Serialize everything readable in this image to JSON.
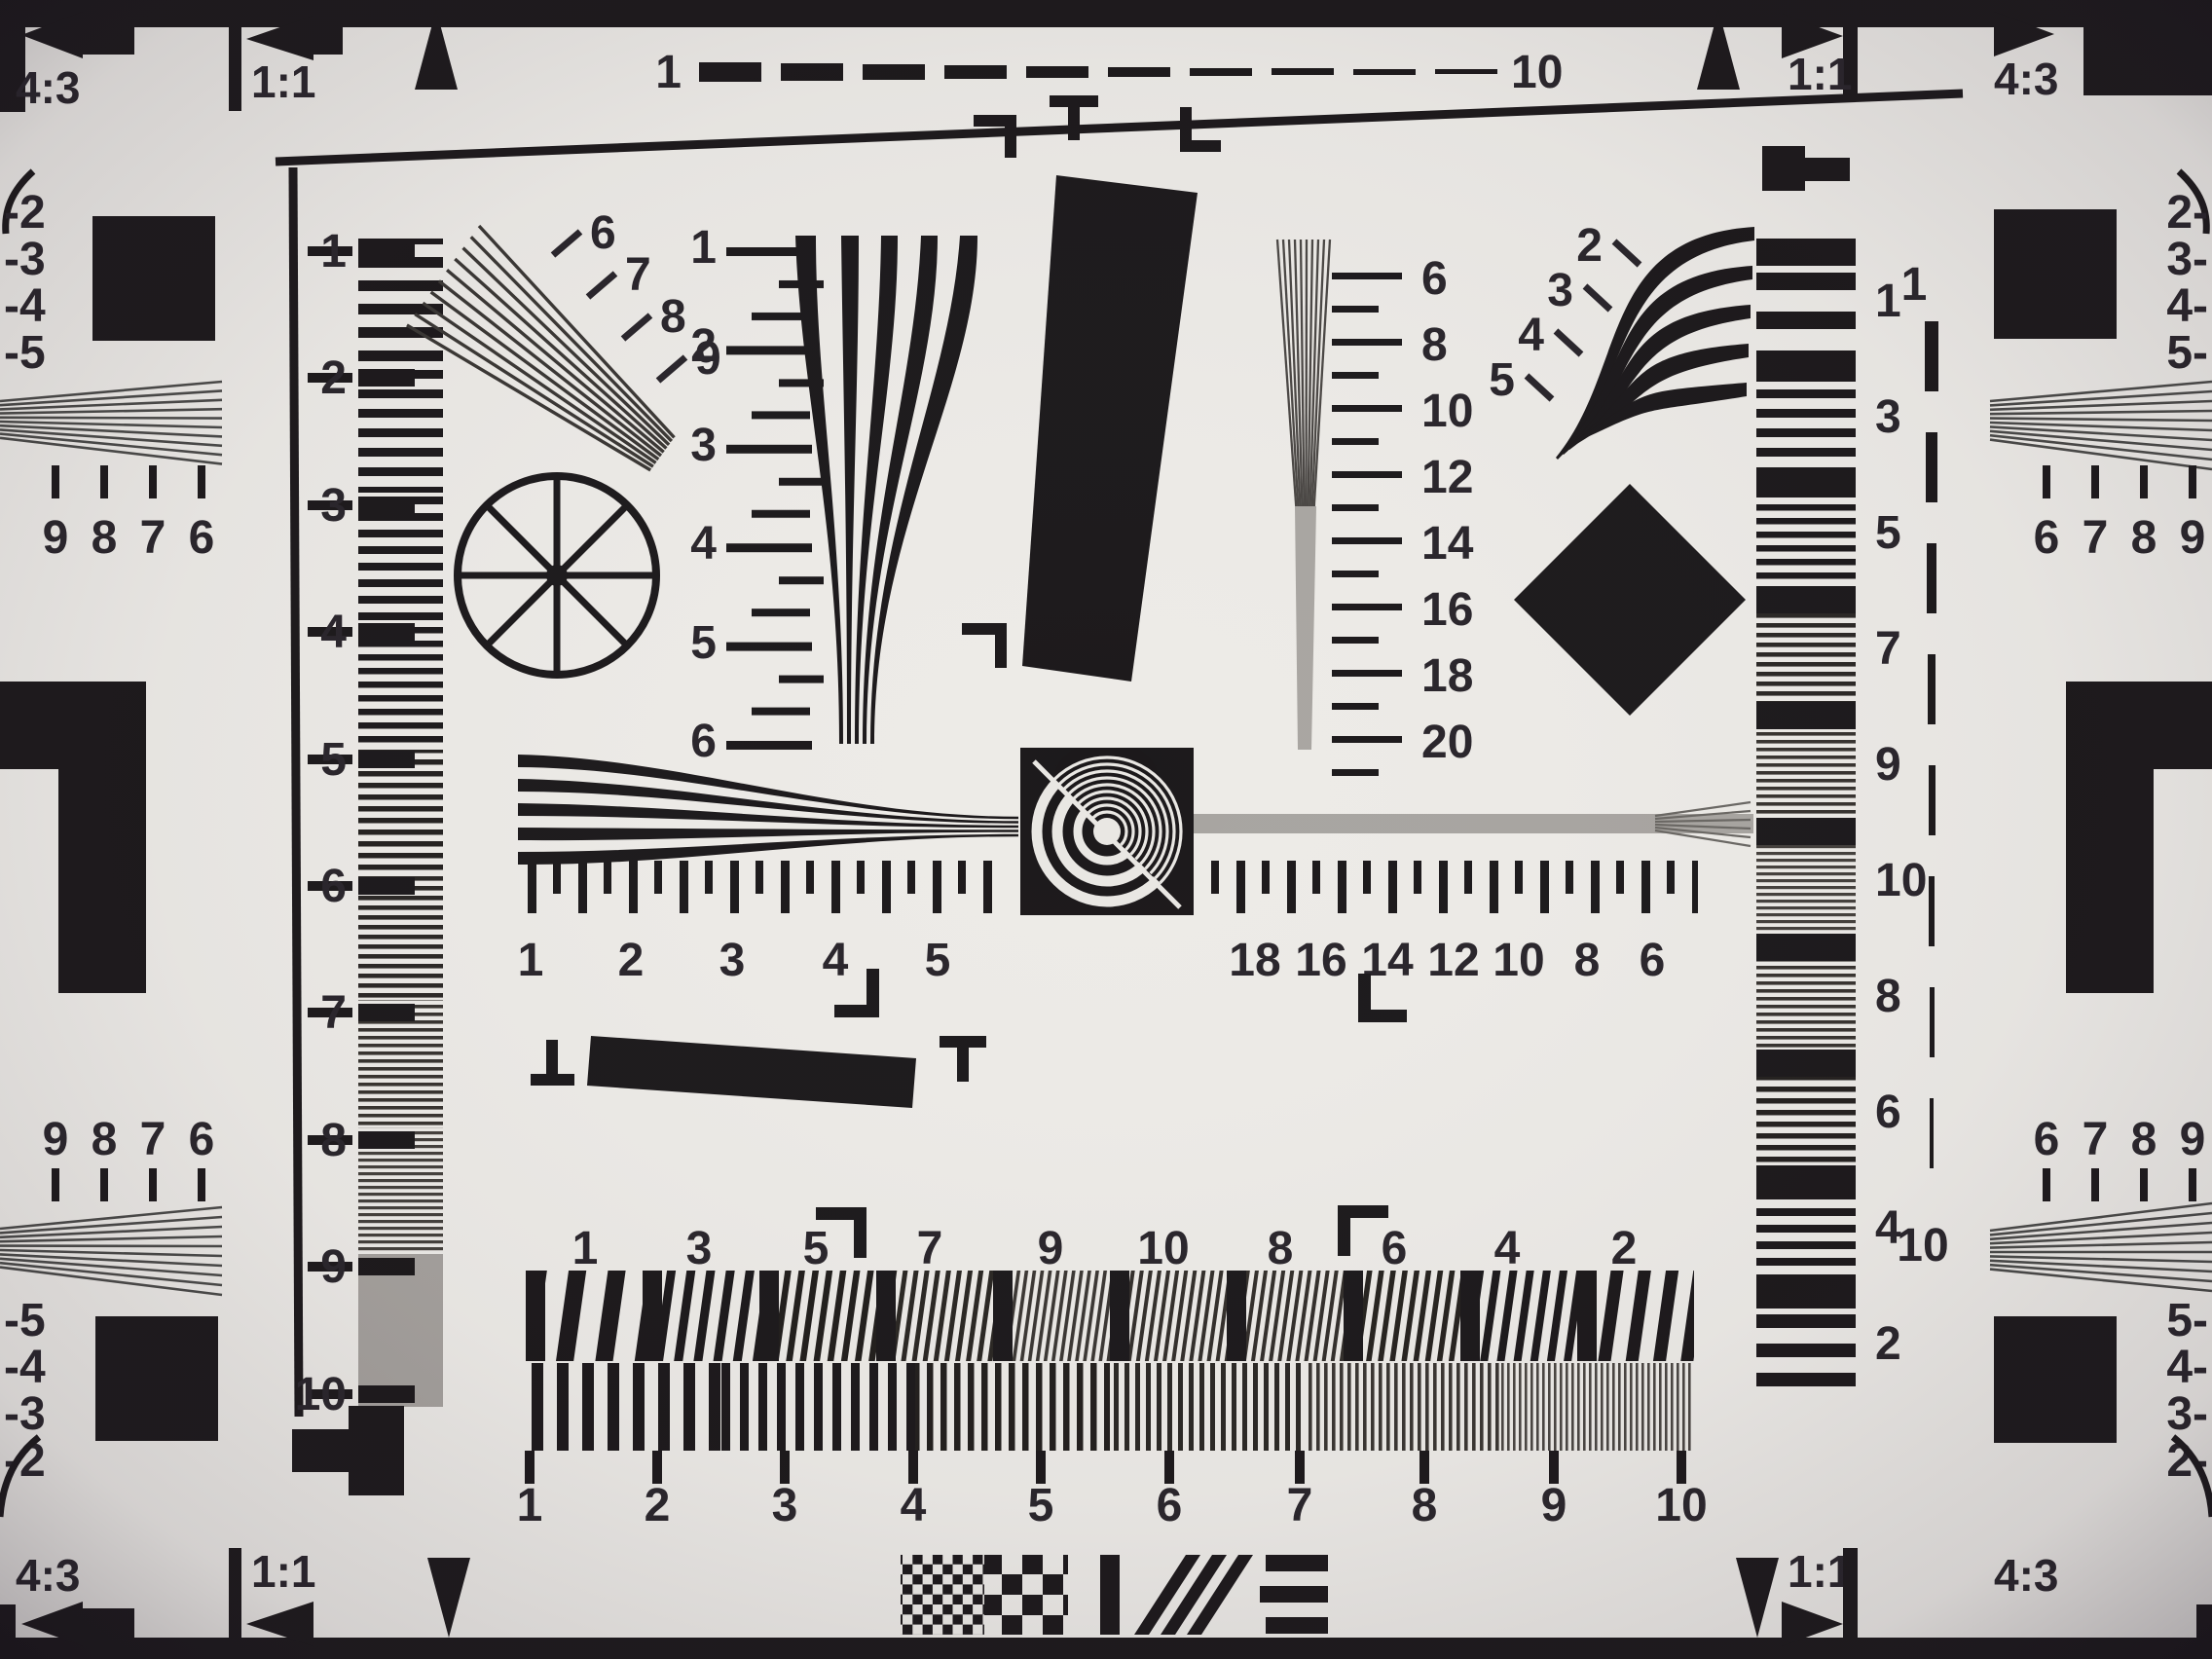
{
  "corners": {
    "ratio_outer": "4:3",
    "ratio_inner": "1:1"
  },
  "top_scale": {
    "start": "1",
    "end": "10"
  },
  "left_strip": {
    "labels": [
      "1",
      "2",
      "3",
      "4",
      "5",
      "6",
      "7",
      "8",
      "9",
      "10"
    ]
  },
  "left_fan": {
    "labels": [
      "6",
      "7",
      "8",
      "9"
    ]
  },
  "v_ruler": {
    "labels": [
      "1",
      "2",
      "3",
      "4",
      "5",
      "6"
    ]
  },
  "mid_scale": {
    "labels": [
      "6",
      "8",
      "10",
      "12",
      "14",
      "16",
      "18",
      "20"
    ]
  },
  "right_fan": {
    "labels": [
      "2",
      "3",
      "4",
      "5"
    ]
  },
  "right_strip": {
    "labels": [
      "1",
      "3",
      "5",
      "7",
      "9",
      "10",
      "8",
      "6",
      "4",
      "2"
    ]
  },
  "dashed_line": {
    "start": "1",
    "end": "10"
  },
  "h_ruler": {
    "left": [
      "1",
      "2",
      "3",
      "4",
      "5"
    ],
    "right": [
      "18",
      "16",
      "14",
      "12",
      "10",
      "8",
      "6"
    ]
  },
  "bottom_wedge": {
    "labels": [
      "1",
      "3",
      "5",
      "7",
      "9",
      "10",
      "8",
      "6",
      "4",
      "2"
    ]
  },
  "bottom_scale": {
    "labels": [
      "1",
      "2",
      "3",
      "4",
      "5",
      "6",
      "7",
      "8",
      "9",
      "10"
    ]
  },
  "edges": {
    "left_top": {
      "neg": [
        "-2",
        "-3",
        "-4",
        "-5"
      ],
      "digits": [
        "9",
        "8",
        "7",
        "6"
      ]
    },
    "left_bottom": {
      "digits": [
        "9",
        "8",
        "7",
        "6"
      ],
      "neg": [
        "-5",
        "-4",
        "-3",
        "-2"
      ]
    },
    "right_top": {
      "neg": [
        "2-",
        "3-",
        "4-",
        "5-"
      ],
      "digits": [
        "6",
        "7",
        "8",
        "9"
      ]
    },
    "right_bottom": {
      "digits": [
        "6",
        "7",
        "8",
        "9"
      ],
      "neg": [
        "5-",
        "4-",
        "3-",
        "2-"
      ]
    }
  },
  "colors": {
    "paper": "#edebe7",
    "ink": "#1c191b",
    "unresolved_gray": "#a8a4a0"
  }
}
